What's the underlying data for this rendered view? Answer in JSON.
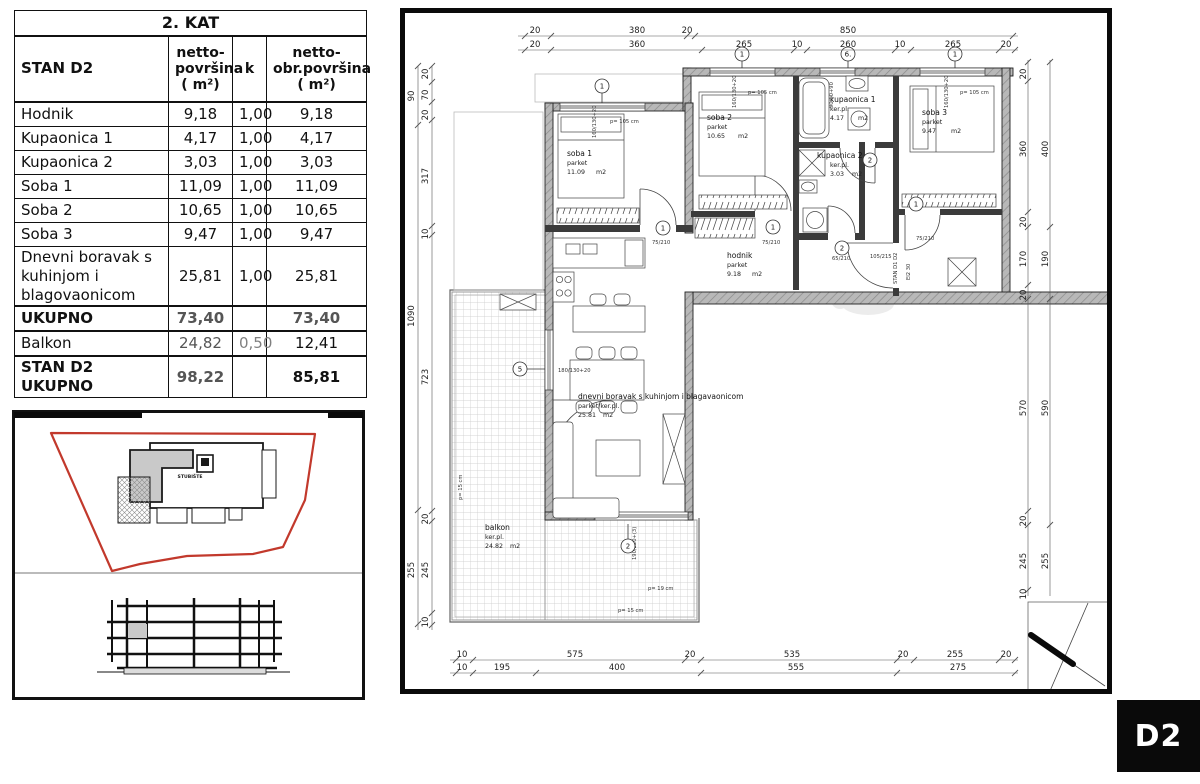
{
  "floor_label": "2. KAT",
  "area_table": {
    "unit_col": "STAN D2",
    "col_netto": [
      "netto-",
      "površina",
      "( m²)"
    ],
    "col_k": "k",
    "col_obr": [
      "netto-",
      "obr.površina",
      "( m²)"
    ],
    "rows": [
      {
        "name": "Hodnik",
        "netto": "9,18",
        "k": "1,00",
        "obr": "9,18"
      },
      {
        "name": "Kupaonica 1",
        "netto": "4,17",
        "k": "1,00",
        "obr": "4,17"
      },
      {
        "name": "Kupaonica 2",
        "netto": "3,03",
        "k": "1,00",
        "obr": "3,03"
      },
      {
        "name": "Soba 1",
        "netto": "11,09",
        "k": "1,00",
        "obr": "11,09"
      },
      {
        "name": "Soba 2",
        "netto": "10,65",
        "k": "1,00",
        "obr": "10,65"
      },
      {
        "name": "Soba 3",
        "netto": "9,47",
        "k": "1,00",
        "obr": "9,47"
      },
      {
        "name": "Dnevni boravak s kuhinjom i blagovaonicom",
        "netto": "25,81",
        "k": "1,00",
        "obr": "25,81"
      }
    ],
    "totals": [
      {
        "name": "UKUPNO",
        "netto": "73,40",
        "k": "",
        "obr": "73,40"
      },
      {
        "name": "Balkon",
        "netto": "24,82",
        "k": "0,50",
        "obr": "12,41"
      },
      {
        "name": "STAN D2 UKUPNO",
        "netto": "98,22",
        "k": "",
        "obr": "85,81"
      }
    ]
  },
  "key_plan": {
    "staircase_label": "STUBIŠTE",
    "outline_color": "#c2392c"
  },
  "unit_badge": "D2",
  "plan": {
    "rooms": {
      "soba1": {
        "name": "soba 1",
        "finish": "parket",
        "area": "11.09",
        "unit": "m2"
      },
      "soba2": {
        "name": "soba 2",
        "finish": "parket",
        "area": "10.65",
        "unit": "m2"
      },
      "soba3": {
        "name": "soba 3",
        "finish": "parket",
        "area": "9.47",
        "unit": "m2"
      },
      "kup1": {
        "name": "kupaonica 1",
        "finish": "ker.pl.",
        "area": "4.17",
        "unit": "m2"
      },
      "kup2": {
        "name": "kupaonica 2",
        "finish": "ker.pl.",
        "area": "3.03",
        "unit": "m2"
      },
      "hodnik": {
        "name": "hodnik",
        "finish": "parket",
        "area": "9.18",
        "unit": "m2"
      },
      "dnevni": {
        "name": "dnevni boravak s kuhinjom i blagavaonicom",
        "finish": "parket/ker.pl.",
        "area": "25.81",
        "unit": "m2"
      },
      "balkon": {
        "name": "balkon",
        "finish": "ker.pl.",
        "area": "24.82",
        "unit": "m2"
      }
    },
    "dims": {
      "top_row1": [
        "20",
        "380",
        "20",
        "850"
      ],
      "top_row2": [
        "20",
        "360",
        "265",
        "10",
        "260",
        "10",
        "265",
        "20"
      ],
      "bottom_row1": [
        "10",
        "575",
        "20",
        "535",
        "20",
        "255",
        "20"
      ],
      "bottom_row2": [
        "10",
        "195",
        "400",
        "555",
        "275"
      ],
      "left_outer": [
        "90",
        "1090",
        "255"
      ],
      "left_inner": [
        "20",
        "70",
        "20",
        "317",
        "10",
        "723",
        "20",
        "245",
        "10"
      ],
      "right_inner": [
        "20",
        "360",
        "20",
        "170",
        "20",
        "570",
        "20",
        "245",
        "10"
      ],
      "right_outer": [
        "400",
        "190",
        "590",
        "255"
      ]
    },
    "axis_bubbles": [
      "1",
      "1",
      "6.",
      "1",
      "5",
      "2"
    ],
    "door_bubbles": [
      "1",
      "1",
      "2",
      "2",
      "1"
    ],
    "window_sizes": [
      "160/130+20",
      "160/130+20",
      "90/60+90",
      "160/130+20",
      "180/130+20",
      "190/220+(3)"
    ],
    "door_sizes": [
      "75/210",
      "75/210",
      "65/210",
      "75/210",
      "105/215"
    ],
    "parapet_notes": {
      "p105": "p= 105 cm",
      "p19": "p= 19 cm",
      "p15": "p= 15 cm"
    },
    "entrance_label": "STAN D1 D2",
    "fire_label": "EI2 30"
  }
}
